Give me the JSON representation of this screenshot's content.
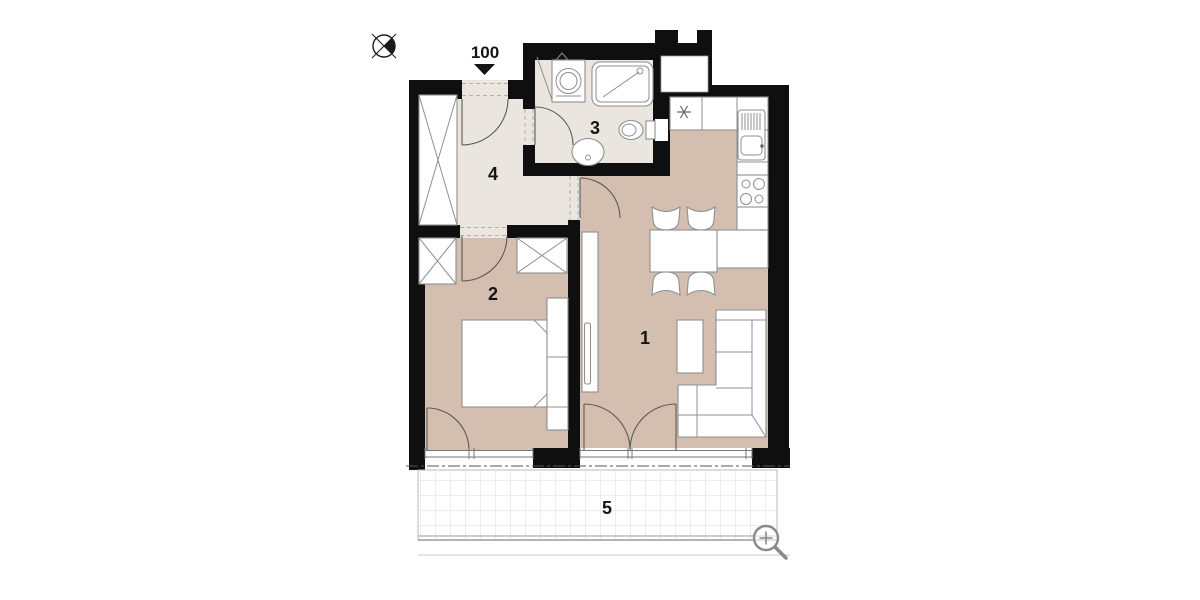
{
  "plan": {
    "entrance": {
      "label": "100"
    },
    "rooms": [
      {
        "key": "living-room-kitchen",
        "number": "1"
      },
      {
        "key": "bedroom",
        "number": "2"
      },
      {
        "key": "bathroom",
        "number": "3"
      },
      {
        "key": "hall",
        "number": "4"
      },
      {
        "key": "terrace",
        "number": "5"
      }
    ],
    "icons": {
      "compass": "north-compass",
      "entrance_arrow": "entrance-direction-arrow",
      "boiler": "boiler-asterisk",
      "zoom": "zoom-magnifier"
    },
    "colors": {
      "wall": "#0f0f0f",
      "floor_main": "#d3beaf",
      "floor_wet": "#eae6df",
      "terrace_grid": "#dcdcdc",
      "terrace_border": "#b8b8b8",
      "furniture_stroke": "#8f8f8f"
    }
  }
}
